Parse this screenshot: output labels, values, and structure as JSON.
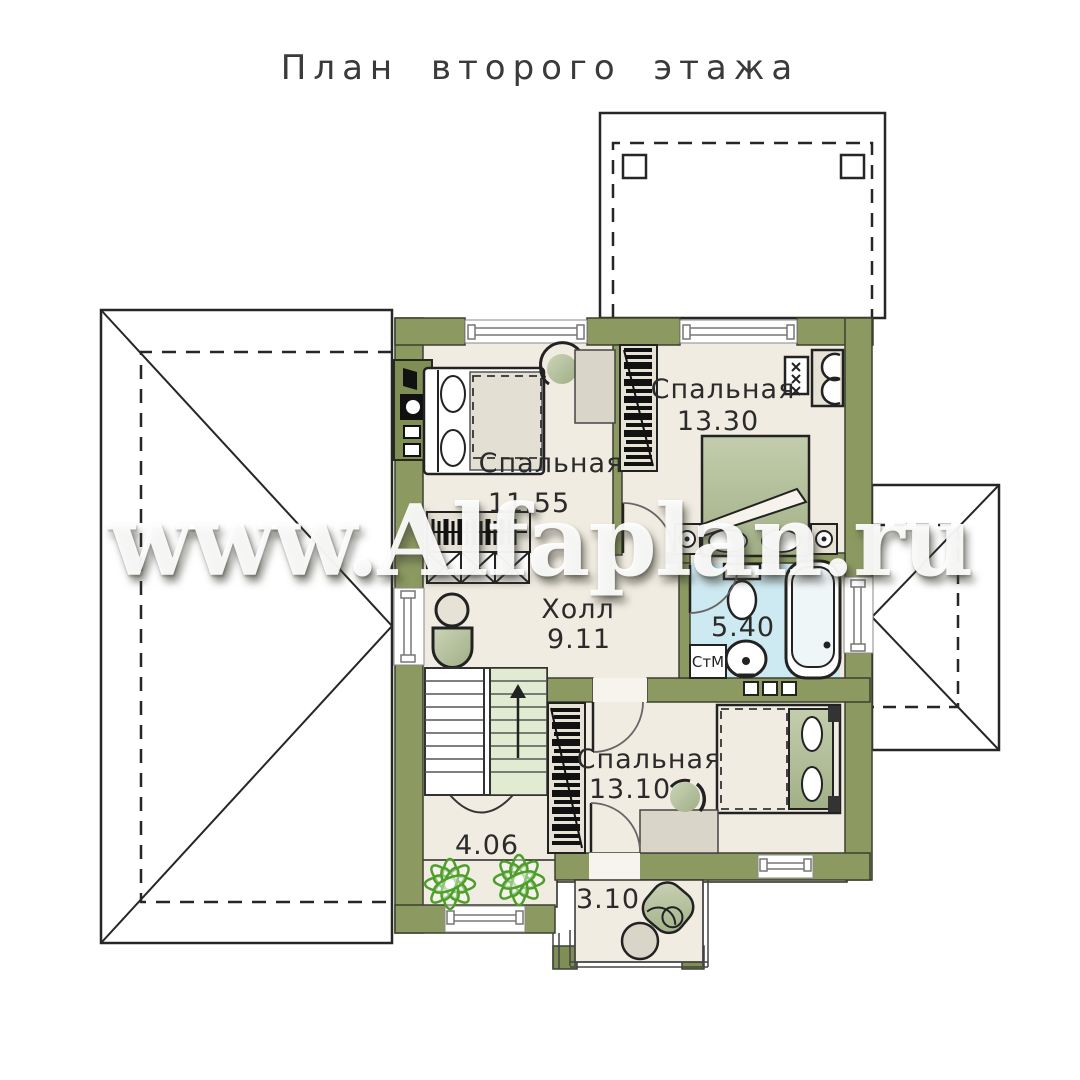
{
  "title": "План второго этажа",
  "watermark": "www.Alfaplan.ru",
  "rooms": {
    "bedroom1": {
      "name": "Спальная",
      "area": "11.55"
    },
    "bedroom2": {
      "name": "Спальная",
      "area": "13.30"
    },
    "hall": {
      "name": "Холл",
      "area": "9.11"
    },
    "bathroom": {
      "name": "",
      "area": "5.40"
    },
    "bedroom3": {
      "name": "Спальная",
      "area": "13.10"
    },
    "attic": {
      "name": "",
      "area": "4.06"
    },
    "balcony": {
      "name": "",
      "area": "3.10"
    }
  },
  "labels": {
    "washing_machine": "СтМ"
  },
  "colors": {
    "wall_green": "#8c9a62",
    "wall_green_dark": "#7e8e54",
    "floor_beige": "#f1ece2",
    "bathroom_blue": "#cde9f1",
    "stairs_green": "#e1ebd1",
    "furniture_gray": "#d9d5c8",
    "furniture_sage": "#aab792",
    "plant_green": "#4e9e2a",
    "line_dark": "#262626"
  }
}
